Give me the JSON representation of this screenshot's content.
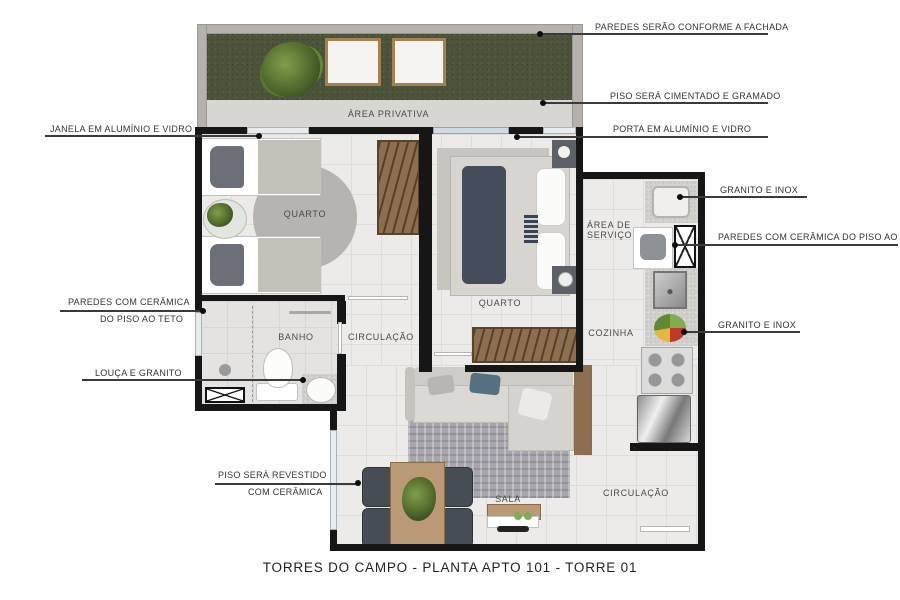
{
  "title": "TORRES DO CAMPO - PLANTA APTO 101 - TORRE 01",
  "rooms": {
    "area_privativa": "ÁREA PRIVATIVA",
    "quarto_1": "QUARTO",
    "quarto_2": "QUARTO",
    "area_servico_line1": "ÁREA DE",
    "area_servico_line2": "SERVIÇO",
    "banho": "BANHO",
    "circulacao_1": "CIRCULAÇÃO",
    "cozinha": "COZINHA",
    "sala": "SALA",
    "circulacao_2": "CIRCULAÇÃO"
  },
  "callouts": {
    "paredes_fachada": "PAREDES SERÃO CONFORME A FACHADA",
    "piso_cimentado": "PISO SERÁ CIMENTADO E GRAMADO",
    "porta_aluminio": "PORTA EM ALUMÍNIO E VIDRO",
    "janela_aluminio": "JANELA EM ALUMÍNIO E VIDRO",
    "granito_inox_top": "GRANITO E INOX",
    "paredes_ceramica_right": "PAREDES COM CERÂMICA DO PISO AO TETO",
    "granito_inox_bottom": "GRANITO E INOX",
    "paredes_ceramica_left_line1": "PAREDES COM CERÂMICA",
    "paredes_ceramica_left_line2": "DO PISO AO TETO",
    "louca_granito": "LOUÇA E GRANITO",
    "piso_revestido_line1": "PISO SERÁ REVESTIDO",
    "piso_revestido_line2": "COM CERÂMICA"
  },
  "colors": {
    "wall": "#161616",
    "grass": "#4d523a",
    "cement": "#d8d6d1",
    "floor": "#ecebe9",
    "wood": "#b99a74",
    "wardrobe": "#8d6f4f",
    "rug": "#b7b3ae",
    "bed_dark": "#454c5b",
    "glass": "#cddde3",
    "plant": "#7fa04a"
  }
}
